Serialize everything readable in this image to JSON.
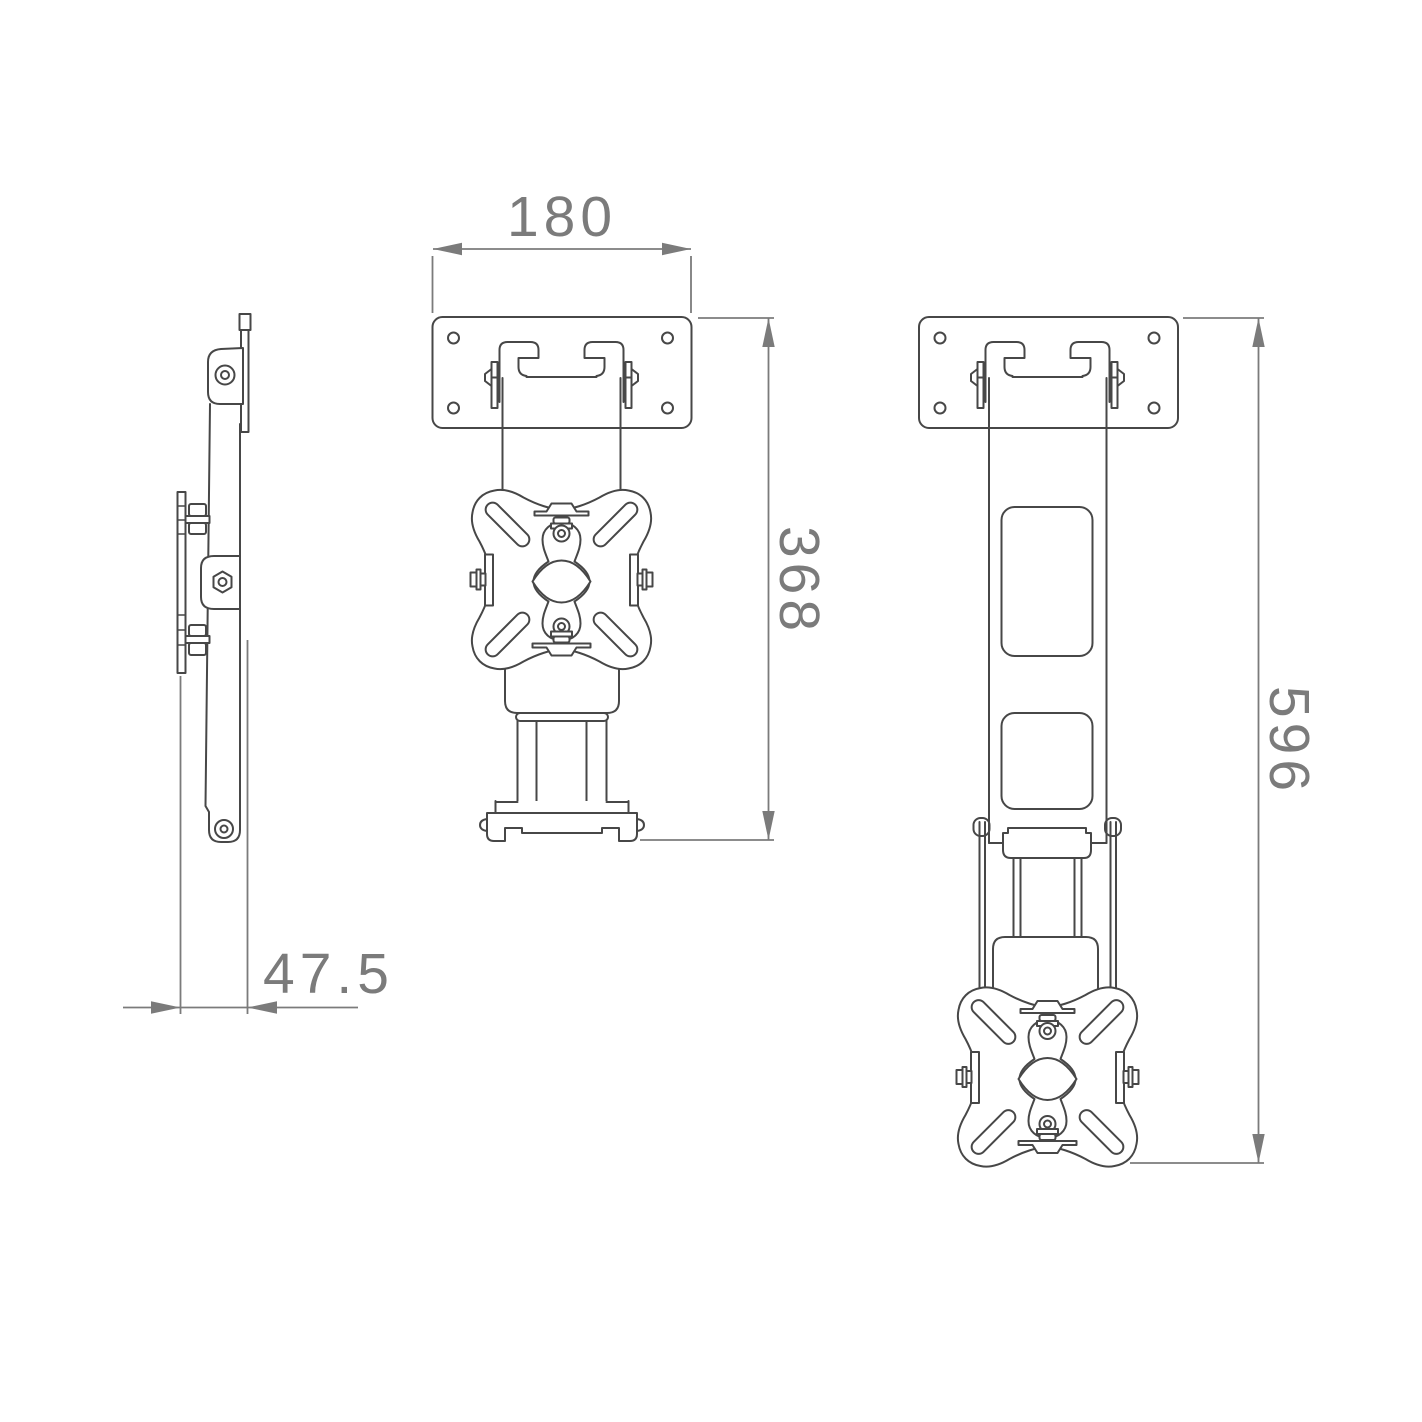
{
  "document": {
    "kind": "technical-drawing",
    "subject": "wall mount bracket - three orthographic views",
    "background": "#ffffff"
  },
  "style": {
    "line_color": "#474747",
    "dimension_color": "#7b7b7b"
  },
  "views": {
    "side": {
      "name": "side-view",
      "dimensions": {
        "depth": {
          "value": "47.5"
        }
      }
    },
    "front_retracted": {
      "name": "front-view-retracted",
      "dimensions": {
        "width": {
          "value": "180"
        },
        "height": {
          "value": "368"
        }
      }
    },
    "front_extended": {
      "name": "front-view-extended",
      "dimensions": {
        "height": {
          "value": "596"
        }
      }
    }
  }
}
